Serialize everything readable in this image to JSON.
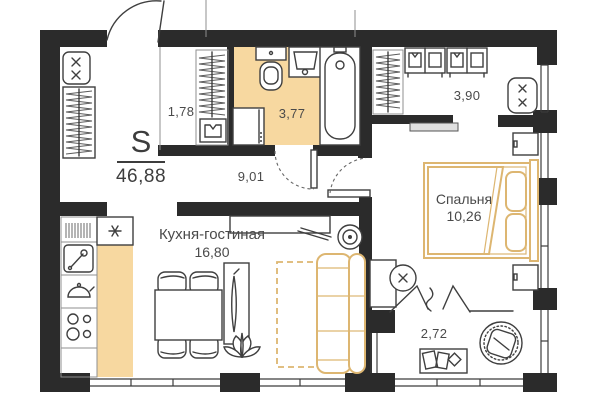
{
  "plan": {
    "summary": {
      "label": "S",
      "area": "46,88"
    },
    "rooms": {
      "closet": {
        "area": "1,78"
      },
      "bathroom": {
        "area": "3,77"
      },
      "hallway": {
        "area": "9,01"
      },
      "dressing": {
        "area": "3,90"
      },
      "kitchen_living": {
        "name": "Кухня-гостиная",
        "area": "16,80"
      },
      "bedroom": {
        "name": "Спальня",
        "area": "10,26"
      },
      "balcony": {
        "area": "2,72"
      }
    },
    "colors": {
      "wall": "#2b2b2b",
      "wet_zone_fill": "#f7d8a0",
      "kitchen_zone_fill": "#f7d8a0",
      "soft_furniture_accent": "#ddb671",
      "line": "#3f3f3f"
    },
    "fixtures": [
      "entry-door",
      "shoe-cabinet",
      "entry-wardrobe-hangers",
      "closet-hangers",
      "shirt-box",
      "toilet",
      "bathroom-sink",
      "washing-machine",
      "bathtub",
      "bathroom-door",
      "bedroom-door",
      "dressing-hangers",
      "shelf-unit",
      "ottoman",
      "sliding-door",
      "fridge-snowflake",
      "dish-rack",
      "kitchen-sink",
      "kettle",
      "stove-burners",
      "dining-table",
      "dining-chair",
      "tv-stand",
      "plant",
      "sofa",
      "rug-dashed",
      "console-table",
      "speaker",
      "bed",
      "pillow",
      "blanket",
      "nightstand",
      "desk",
      "desk-chair",
      "curtain-zigzag",
      "papasan-chair",
      "balcony-rug",
      "window"
    ]
  }
}
